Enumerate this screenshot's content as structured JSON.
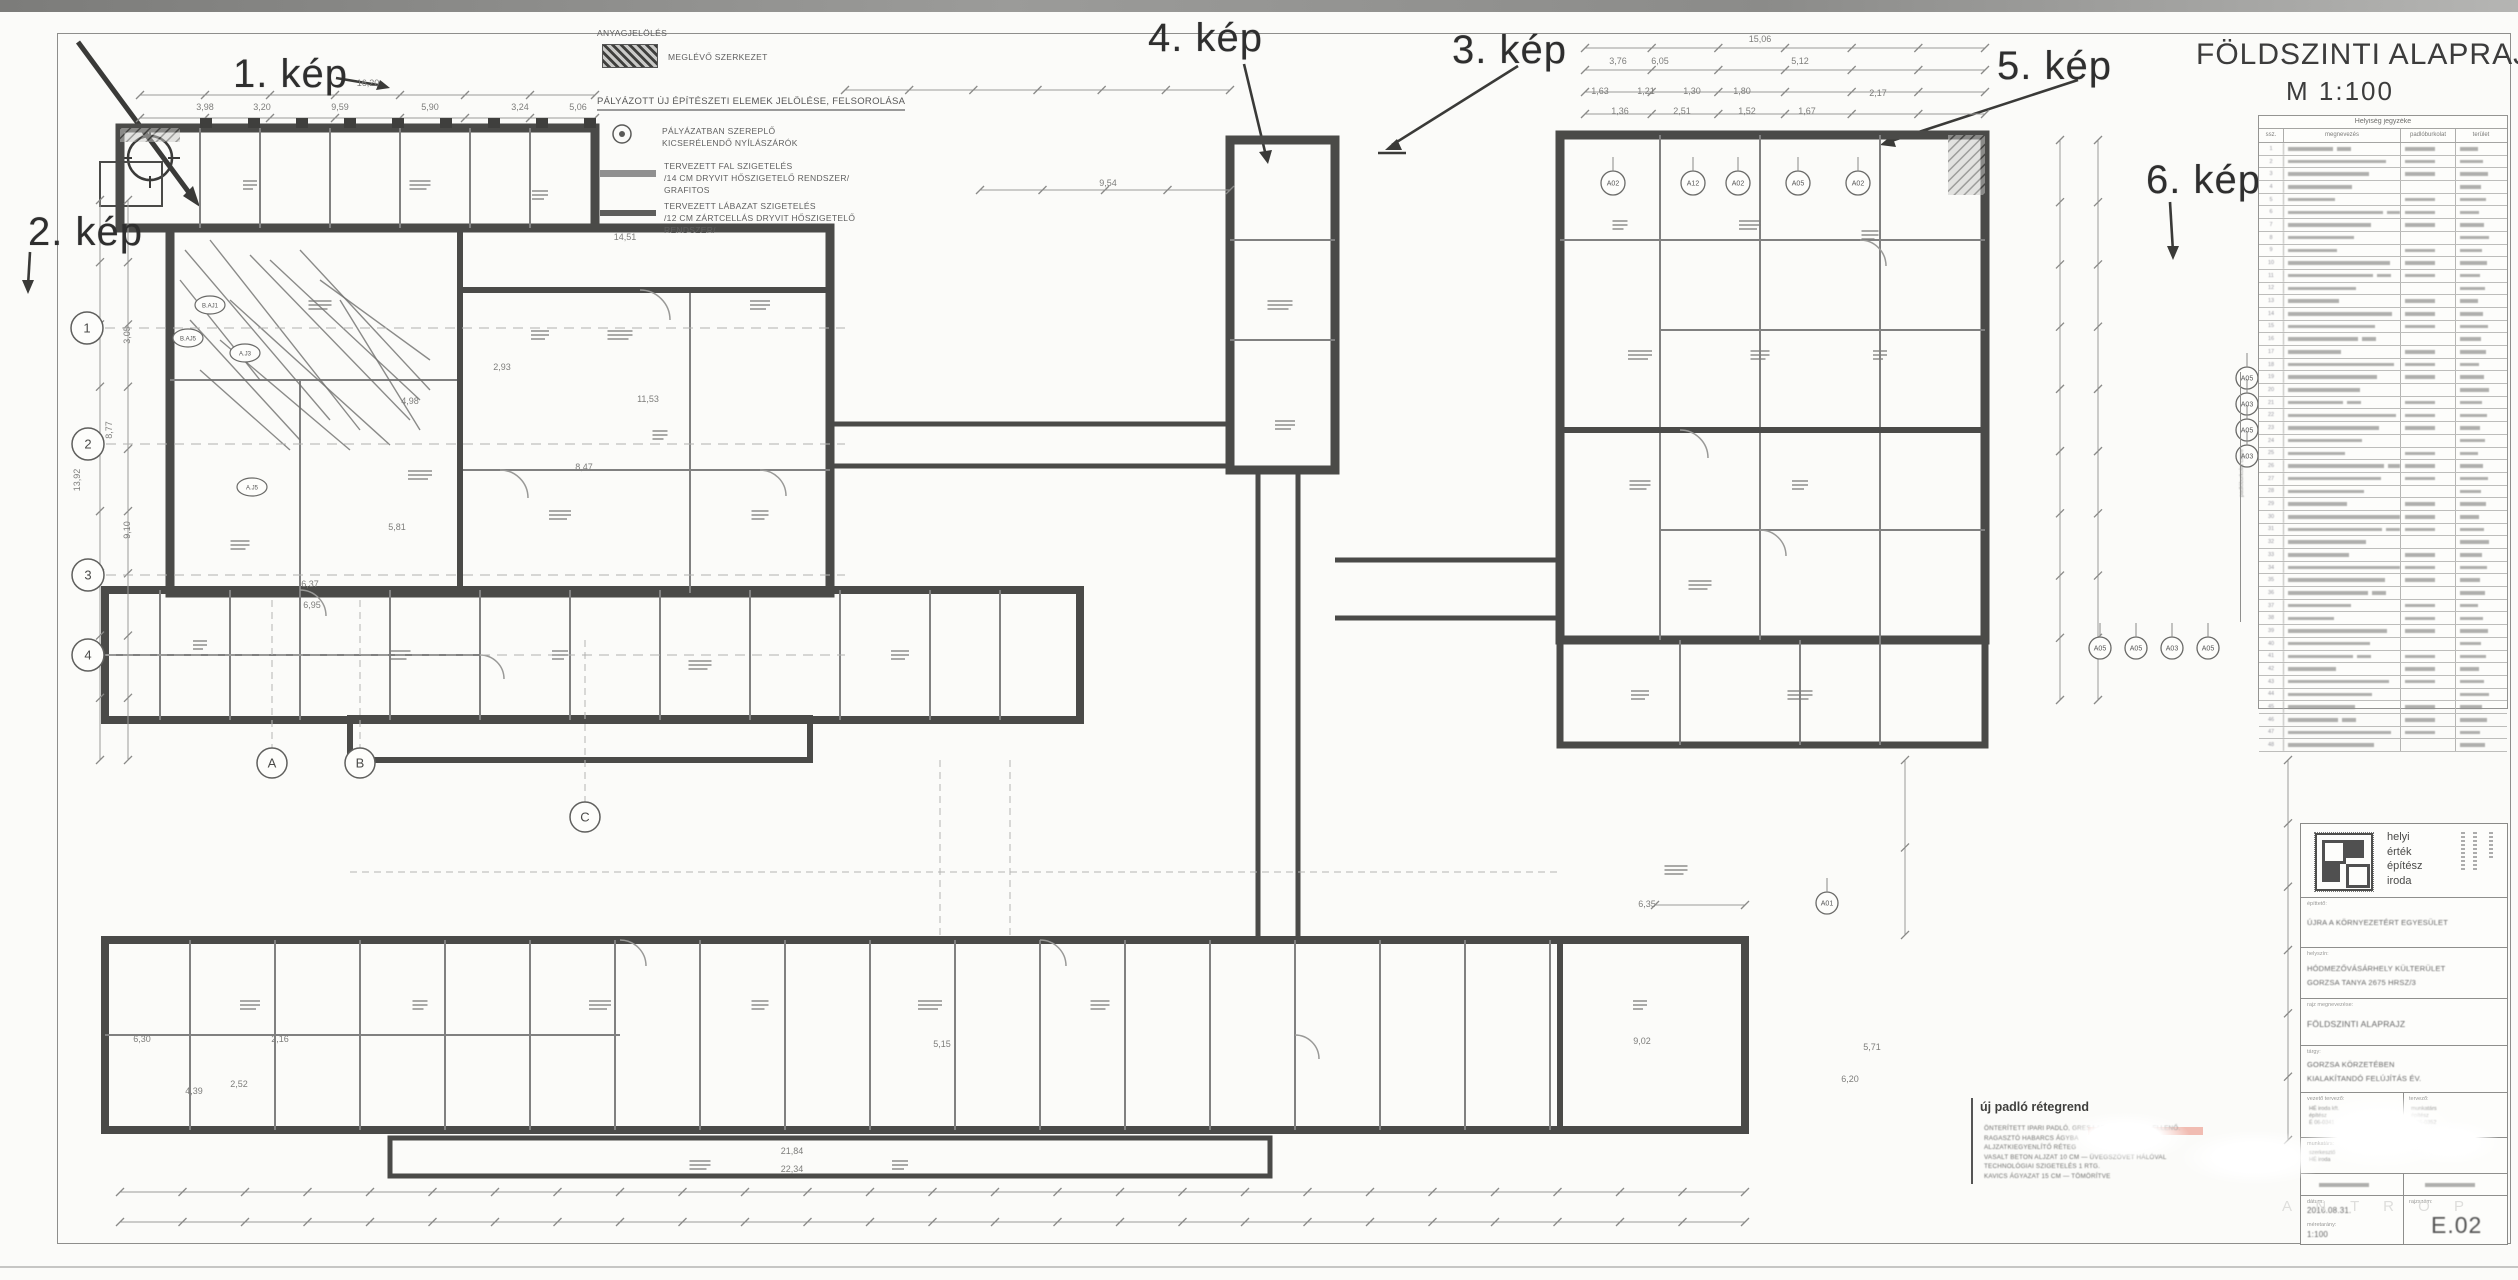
{
  "sheet": {
    "title": "FÖLDSZINTI ALAPRAJZ",
    "scale": "M 1:100"
  },
  "annotations": {
    "kep_labels": [
      "1. kép",
      "2. kép",
      "3. kép",
      "4. kép",
      "5. kép",
      "6. kép"
    ]
  },
  "legend": {
    "materials_heading": "ANYAGJELÖLÉS",
    "existing": "MEGLÉVŐ SZERKEZET",
    "new_heading": "PÁLYÁZOTT ÚJ ÉPÍTÉSZETI ELEMEK JELÖLÉSE, FELSOROLÁSA",
    "openings_line1": "PÁLYÁZATBAN SZEREPLŐ",
    "openings_line2": "KICSERÉLENDŐ NYÍLÁSZÁRÓK",
    "wall_line1": "TERVEZETT FAL SZIGETELÉS",
    "wall_line2": "/14 CM DRYVIT HŐSZIGETELŐ RENDSZER/",
    "wall_line3": "GRAFITOS",
    "plinth_line1": "TERVEZETT LÁBAZAT SZIGETELÉS",
    "plinth_line2": "/12 CM ZÁRTCELLÁS DRYVIT HŐSZIGETELŐ",
    "plinth_line3": "RENDSZER/"
  },
  "schedule": {
    "title": "Helyiség jegyzéke",
    "columns": [
      "ssz.",
      "megnevezés",
      "padlóburkolat",
      "terület"
    ],
    "row_count": 48,
    "side_label": "padlóburkolat csere"
  },
  "titleblock": {
    "logo_lines": [
      "helyi",
      "érték",
      "építész",
      "iroda"
    ],
    "client_label": "építtető:",
    "client": "ÚJRA A KÖRNYEZETÉRT EGYESÜLET",
    "site_label": "helyszín:",
    "site_line1": "HÓDMEZŐVÁSÁRHELY KÜLTERÜLET",
    "site_line2": "GORZSA TANYA 2675 HRSZ/3",
    "drawing_label": "rajz megnevezése:",
    "drawing": "FÖLDSZINTI ALAPRAJZ",
    "subject_label": "tárgy:",
    "subject_line1": "GORZSA KÖRZETÉBEN",
    "subject_line2": "KIALAKÍTANDÓ FELÚJÍTÁS ÉV.",
    "designer_label": "vezető tervező:",
    "designer_lines": [
      "HÉ iroda kft.",
      "építész",
      "É 06-0341"
    ],
    "architect_label": "tervező:",
    "architect_lines": [
      "munkatárs",
      "építész",
      "É 06-0352"
    ],
    "associate_label": "munkatárs:",
    "associate_lines": [
      "szerkesztő",
      "HÉ iroda"
    ],
    "date_label": "dátum:",
    "date": "2016.08.31.",
    "scale_label": "méretarány:",
    "scale": "1:100",
    "number_label": "rajzszám:",
    "number": "E.02"
  },
  "notes": {
    "heading": "új padló rétegrend",
    "lines": [
      "ÖNTERÍTETT IPARI PADLÓ, GRES LAP BURKOLAT — ELLENŐ.",
      "RAGASZTÓ HABARCS ÁGYBA",
      "ALJZATKIEGYENLÍTŐ RÉTEG",
      "VASALT BETON ALJZAT 10 CM — ÜVEGSZÖVET HÁLÓVAL",
      "TECHNOLÓGIAI SZIGETELÉS 1 RTG.",
      "KAVICS ÁGYAZAT 15 CM — TÖMÖRÍTVE"
    ]
  },
  "watermark_text": "A N T R O P",
  "plan": {
    "grid_bubbles_numbers": [
      "1",
      "2",
      "3",
      "4"
    ],
    "grid_bubbles_letters": [
      "A",
      "B",
      "C"
    ],
    "window_markers_top": [
      "A02",
      "A12",
      "A02",
      "A05",
      "A02"
    ],
    "window_markers_right": [
      "A05",
      "A03",
      "A05",
      "A03"
    ],
    "window_markers_bottom": [
      "A05",
      "A05",
      "A03",
      "A05"
    ],
    "marker_a01": "A01",
    "door_markers": [
      "A.J3",
      "A.J5",
      "B.AJ1",
      "B.AJ5"
    ],
    "dims": [
      "16,20",
      "3,98",
      "3,20",
      "9,59",
      "5,90",
      "3,24",
      "5,06",
      "9,54",
      "14,51",
      "15,06",
      "6,05",
      "5,12",
      "3,76",
      "1,63",
      "1,21",
      "1,30",
      "1,80",
      "1,36",
      "2,51",
      "1,52",
      "1,67",
      "2,17",
      "13,92",
      "8,77",
      "9,10",
      "3,05",
      "6,37",
      "6,95",
      "5,81",
      "11,53",
      "8,47",
      "21,84",
      "22,34",
      "5,71",
      "6,20",
      "9,02",
      "5,15",
      "6,30",
      "4,39",
      "2,52",
      "2,16",
      "12,96",
      "11,58",
      "6,35",
      "2,93",
      "4,98"
    ]
  }
}
